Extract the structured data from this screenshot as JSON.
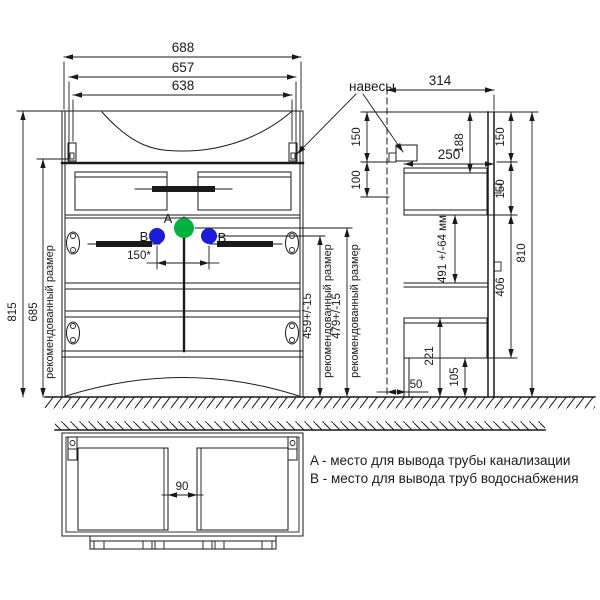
{
  "colors": {
    "ink": "#1a1a1a",
    "point_a": "#00b140",
    "point_b": "#1b1bd8"
  },
  "front": {
    "dim_width_overall": "688",
    "dim_width_657": "657",
    "dim_width_638": "638",
    "dim_height_overall": "815",
    "dim_height_hangers": "685",
    "recommended_size": "рекомендованный размер",
    "dim_b_spacing": "150*",
    "dim_drain_height": "459+/-15",
    "dim_supply_height": "479+/-15",
    "point_a": "A",
    "point_b": "B"
  },
  "side": {
    "hangers": "навесы",
    "dim_depth": "314",
    "dim_top_to_hanger": "150",
    "dim_hanger_range": "100",
    "dim_top_section": "188",
    "dim_drawer_depth": "250",
    "dim_right_top": "150",
    "dim_right_mid": "150",
    "dim_siphon": "491 +/-64 мм",
    "dim_lower": "406",
    "dim_height": "810",
    "dim_bottom_box": "221",
    "dim_plinth": "105",
    "dim_wall_gap": "50"
  },
  "plan": {
    "dim_center_gap": "90"
  },
  "legend": {
    "line_a": "A - место для вывода трубы канализации",
    "line_b": "B - место для вывода труб водоснабжения"
  }
}
